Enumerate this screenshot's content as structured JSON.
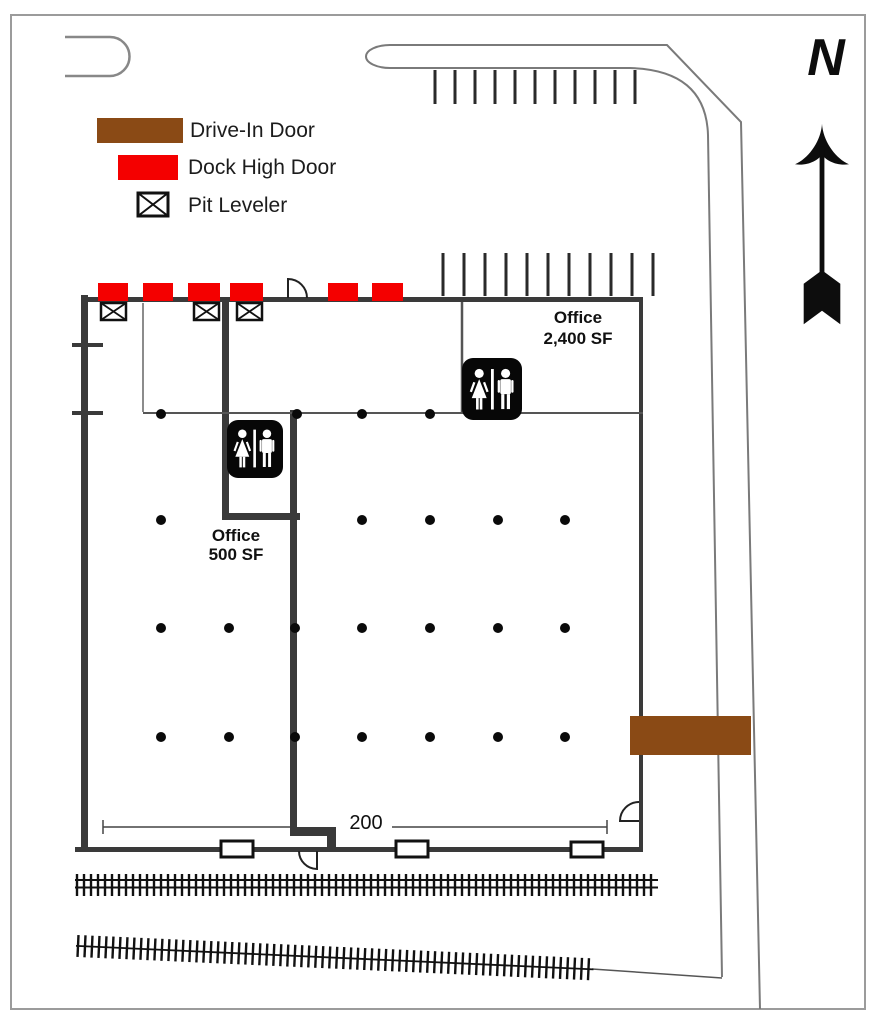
{
  "plan": {
    "legend": {
      "drive_in_label": "Drive-In Door",
      "dock_high_label": "Dock High Door",
      "pit_leveler_label": "Pit Leveler"
    },
    "compass": {
      "north_label": "N"
    },
    "offices": {
      "large": {
        "line1": "Office",
        "line2": "2,400 SF"
      },
      "small": {
        "line1": "Office",
        "line2": "500 SF"
      }
    },
    "dimension": {
      "south_wall_length": "200"
    },
    "colors": {
      "drive_in_door": "#8a4a15",
      "dock_high_door": "#f40000",
      "wall_dark": "#3a3a3a"
    }
  }
}
